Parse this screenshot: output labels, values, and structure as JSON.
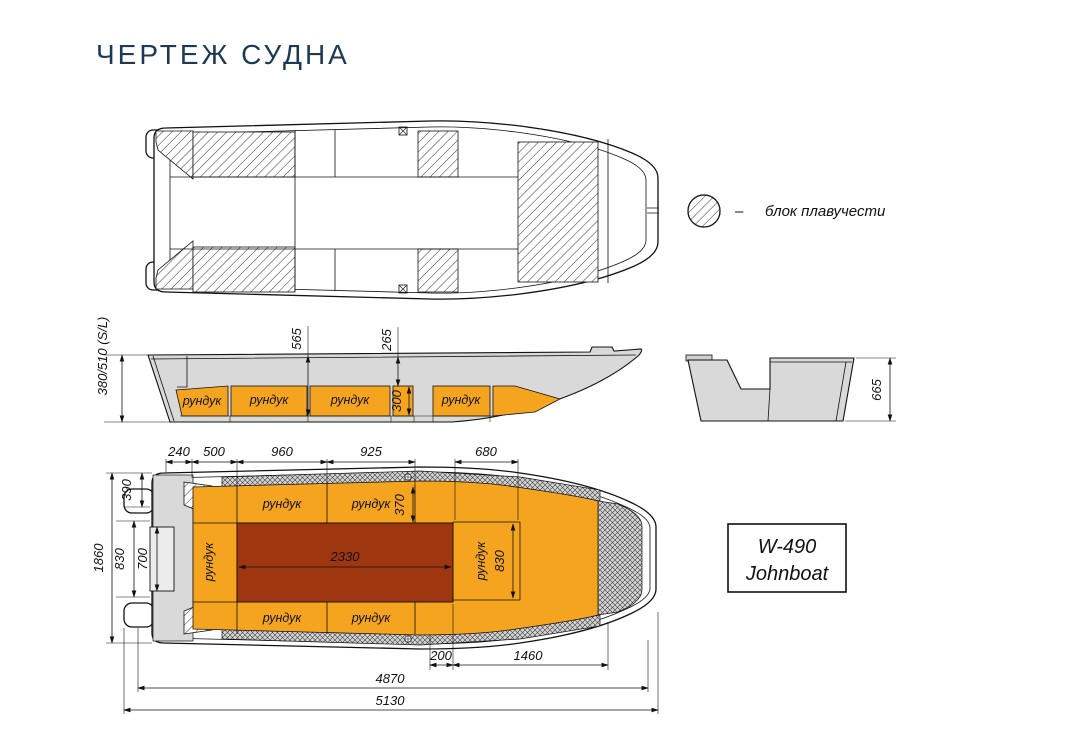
{
  "title": "ЧЕРТЕЖ СУДНА",
  "colors": {
    "title_navy": "#1d3a55",
    "locker_orange": "#F5A41F",
    "floor_red": "#9E3610",
    "hull_grey": "#D9D9D9",
    "line_black": "#111111"
  },
  "legend": {
    "separator": "–",
    "label": "блок плавучести"
  },
  "model_box": {
    "line1": "W-490",
    "line2": "Johnboat"
  },
  "side_view": {
    "lockers": [
      "рундук",
      "рундук",
      "рундук",
      "рундук"
    ],
    "dims": {
      "depth_overall": "380/510 (S/L)",
      "depth_mid": "565",
      "depth_fore": "265",
      "locker_height": "300"
    }
  },
  "section_view": {
    "dims": {
      "height": "665"
    }
  },
  "deck_view": {
    "lockers": {
      "top": [
        "рундук",
        "рундук"
      ],
      "bottom": [
        "рундук",
        "рундук"
      ],
      "left": "рундук",
      "right": "рундук"
    },
    "dims": {
      "top": [
        "240",
        "500",
        "960",
        "925",
        "680"
      ],
      "left": [
        "1860",
        "390",
        "830",
        "700"
      ],
      "cockpit_length": "2330",
      "locker_depth_top": "370",
      "locker_width_right": "830",
      "bottom": [
        "200",
        "1460",
        "4870",
        "5130"
      ]
    }
  }
}
